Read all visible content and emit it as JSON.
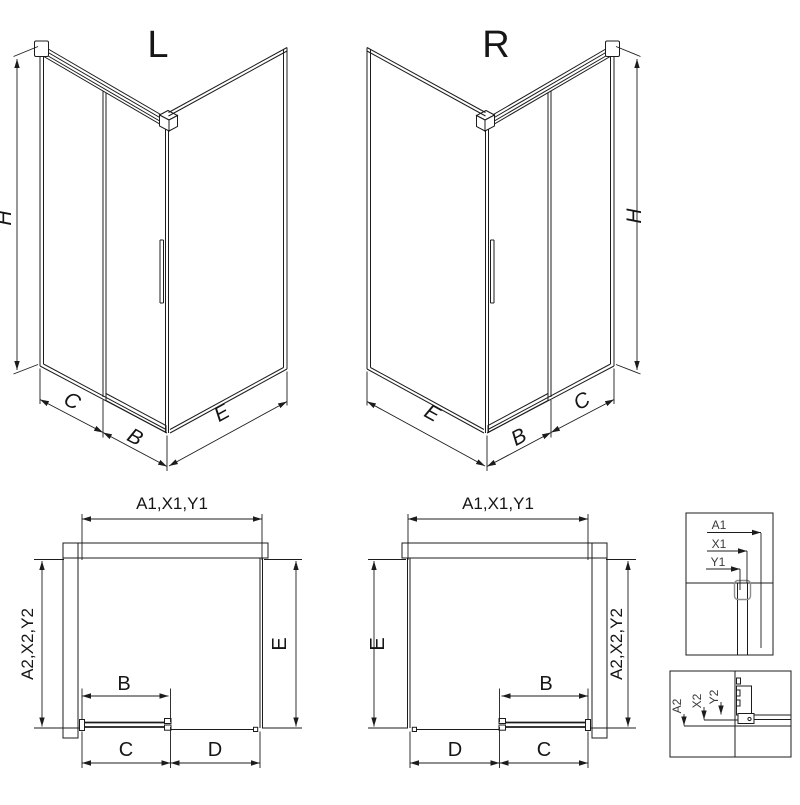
{
  "drawing": {
    "iso_left": {
      "title": "L",
      "dim_height": "H",
      "dim_fixed": "C",
      "dim_door": "B",
      "dim_side": "E"
    },
    "iso_right": {
      "title": "R",
      "dim_height": "H",
      "dim_fixed": "C",
      "dim_door": "B",
      "dim_side": "E"
    },
    "plan_left": {
      "dim_top": "A1,X1,Y1",
      "dim_left": "A2,X2,Y2",
      "dim_right": "E",
      "dim_door": "B",
      "dim_bottom_near": "C",
      "dim_bottom_far": "D"
    },
    "plan_right": {
      "dim_top": "A1,X1,Y1",
      "dim_left": "E",
      "dim_right": "A2,X2,Y2",
      "dim_door": "B",
      "dim_bottom_far": "D",
      "dim_bottom_near": "C"
    },
    "detail_top": {
      "l1": "A1",
      "l2": "X1",
      "l3": "Y1"
    },
    "detail_bottom": {
      "l1": "A2",
      "l2": "X2",
      "l3": "Y2"
    }
  },
  "colors": {
    "line": "#1c1c1c",
    "muted": "#8f8f8f",
    "background": "#ffffff"
  }
}
